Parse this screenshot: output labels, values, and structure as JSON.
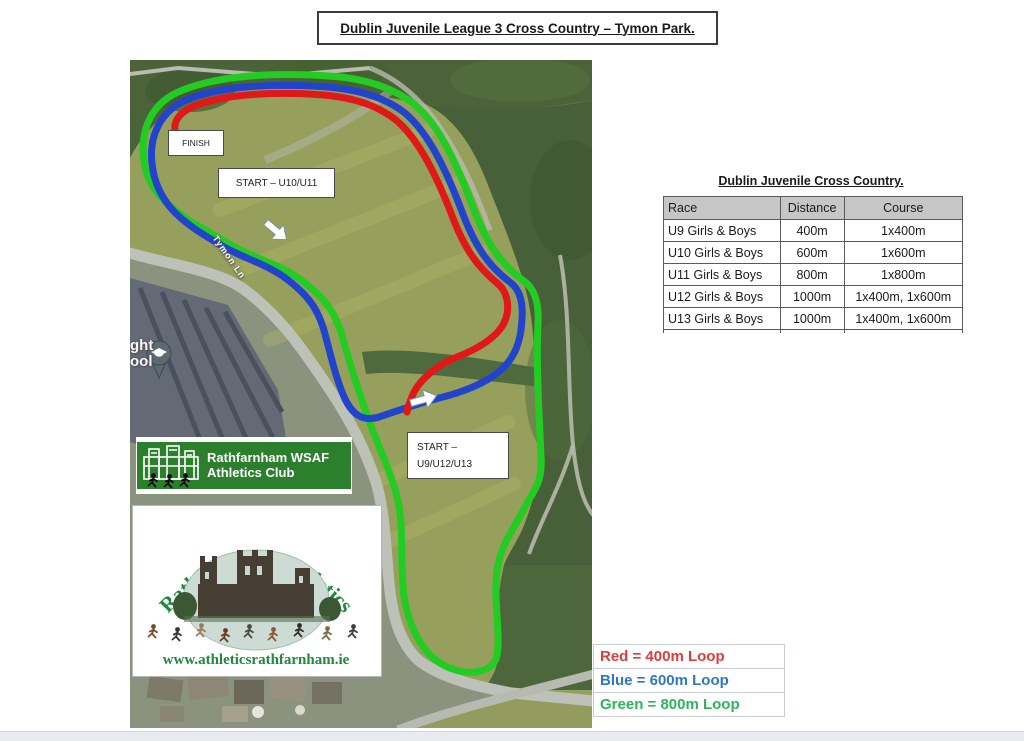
{
  "title": "Dublin Juvenile League 3 Cross Country – Tymon Park.",
  "map": {
    "finish_label": "FINISH",
    "start_u10_u11_label": "START – U10/U11",
    "start_u9_u12_u13_line1": "START –",
    "start_u9_u12_u13_line2": "U9/U12/U13",
    "road_label": "Tymon Ln",
    "clipped_poi_text_line1": "ght",
    "clipped_poi_text_line2": "ool",
    "banner": {
      "line1": "Rathfarnham WSAF",
      "line2": "Athletics Club"
    },
    "logo": {
      "arch_text": "Rathfarnham Athletics",
      "website": "www.athleticsrathfarnham.ie"
    }
  },
  "table": {
    "title": "Dublin Juvenile Cross Country.",
    "headers": [
      "Race",
      "Distance",
      "Course"
    ],
    "rows": [
      [
        "U9 Girls & Boys",
        "400m",
        "1x400m"
      ],
      [
        "U10 Girls & Boys",
        "600m",
        "1x600m"
      ],
      [
        "U11 Girls & Boys",
        "800m",
        "1x800m"
      ],
      [
        "U12 Girls & Boys",
        "1000m",
        "1x400m, 1x600m"
      ],
      [
        "U13 Girls & Boys",
        "1000m",
        "1x400m, 1x600m"
      ],
      [
        "U14 Girls & Boys",
        "1200m",
        "2x600m"
      ]
    ]
  },
  "legend": {
    "items": [
      {
        "label": "Red = 400m Loop",
        "color": "#e03a3a"
      },
      {
        "label": "Blue = 600m Loop",
        "color": "#2e78c2"
      },
      {
        "label": "Green = 800m Loop",
        "color": "#2eb45c"
      }
    ]
  },
  "colors": {
    "loop_red": "#e01818",
    "loop_blue": "#2244cc",
    "loop_green": "#22cc22",
    "banner_green": "#2c7f2c",
    "logo_green": "#1e8a3a",
    "table_header_gray": "#c6c6c6"
  }
}
